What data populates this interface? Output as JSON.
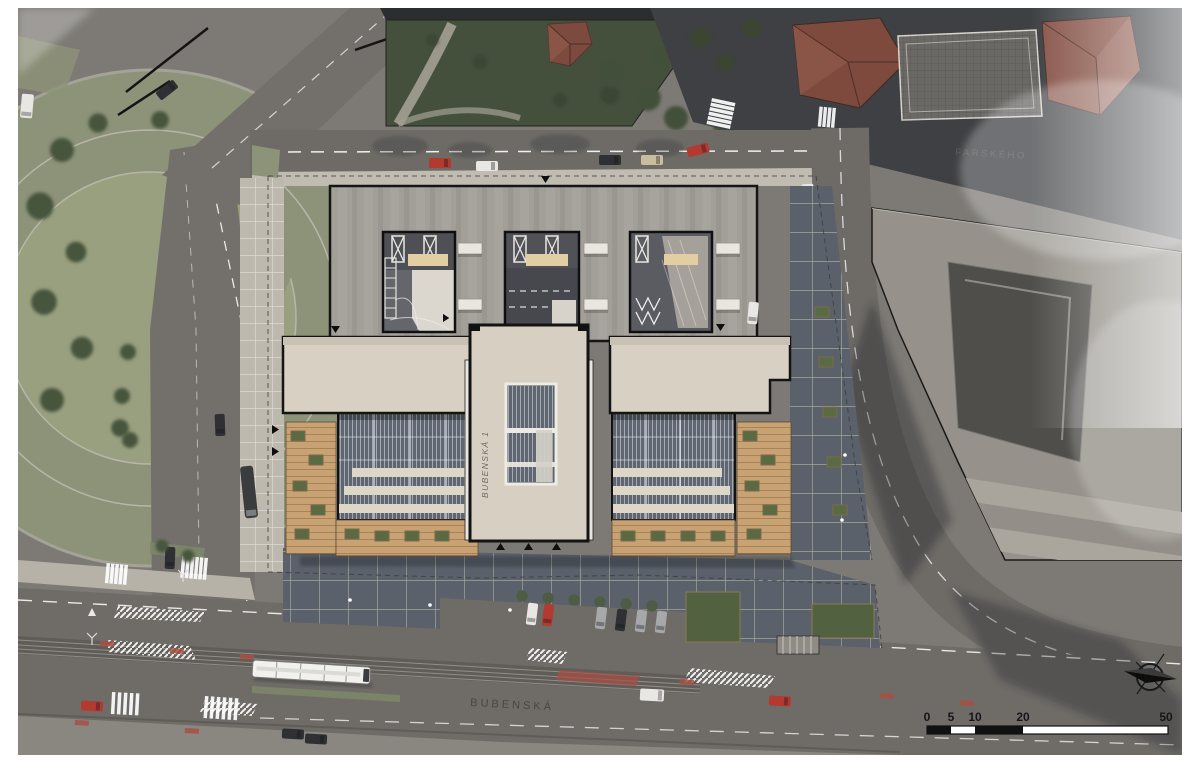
{
  "type": "architectural-site-plan-aerial-render",
  "labels": {
    "main_street": "BUBENSKÁ",
    "secondary_street_faint": "FARSKÉHO",
    "building_roof_text": "BUBENSKÁ 1"
  },
  "scale_bar": {
    "ticks": [
      "0",
      "5",
      "10",
      "20",
      "50"
    ]
  },
  "icons": {
    "north_arrow": "compass-north-arrow"
  },
  "palette": {
    "paper_white": "#ffffff",
    "road_gray": "#6f6c68",
    "dark_road": "#3e4043",
    "park_green": "#8d9378",
    "tree_green": "#46543d",
    "garden_dark_green": "#45503c",
    "plaza_light": "#beb9ae",
    "plaza_dark": "#5a616b",
    "roof_concrete": "#a29e98",
    "building_cream": "#d8d1c3",
    "courtyard_gray": "#55575d",
    "glass_blue_gray": "#5f6671",
    "skylight_beige": "#e3cda3",
    "wood_deck": "#c9a273",
    "red_roof": "#7d4a3d",
    "marking_white": "#ffffff",
    "marking_red": "#a84f44",
    "ink_black": "#111111"
  }
}
